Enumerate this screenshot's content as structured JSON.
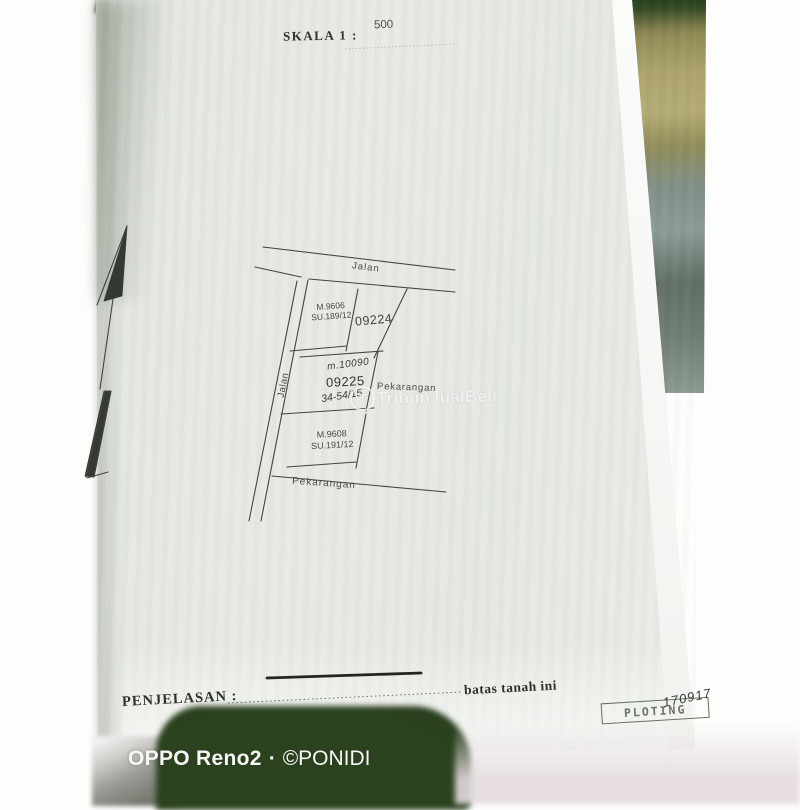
{
  "paper": {
    "header": {
      "scale_label": "SKALA 1 :",
      "scale_value": "500"
    },
    "map": {
      "road_top_label": "Jalan",
      "road_left_label": "Jalan",
      "parcels": [
        {
          "cert": "M.9606",
          "survey": "SU.189/12"
        },
        {
          "number": "09224"
        },
        {
          "number": "09225",
          "handwriting_top": "m.10090",
          "handwriting_bottom": "34-54/15"
        },
        {
          "cert": "M.9608",
          "survey": "SU.191/12"
        }
      ],
      "land_label_right": "Pekarangan",
      "land_label_bottom": "Pekarangan",
      "north_arrow": "pen-drawn north arrow"
    },
    "legend": {
      "label": "PENJELASAN :",
      "description": "batas tanah ini",
      "symbol": "solid line"
    },
    "stamp": {
      "text": "PLOTING",
      "handwriting": "170917"
    }
  },
  "site_watermark": {
    "logo": "T",
    "text": "TribunJualBeli"
  },
  "camera_overlay": {
    "device": "OPPO Reno2",
    "separator": "·",
    "credit": "©PONIDI"
  },
  "colors": {
    "paper": "#e5e8e3",
    "ink": "#42463f",
    "fabric_dark_green": "#2c431f",
    "fabric_khaki": "#aaa268",
    "fabric_blue_gray": "#8a9a94",
    "camera_text": "#f7f7f5"
  }
}
